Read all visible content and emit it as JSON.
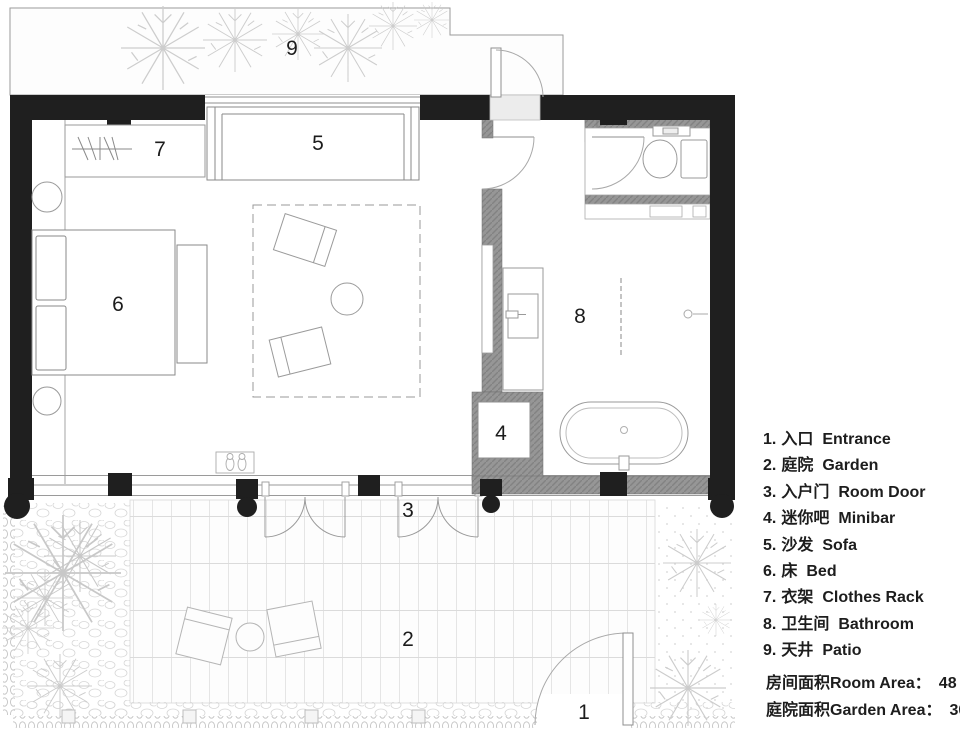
{
  "plan": {
    "labels": {
      "r1": "1",
      "r2": "2",
      "r3": "3",
      "r4": "4",
      "r5": "5",
      "r6": "6",
      "r7": "7",
      "r8": "8",
      "r9": "9"
    }
  },
  "legend": {
    "items": [
      {
        "num": "1.",
        "zh": "入口",
        "en": "Entrance"
      },
      {
        "num": "2.",
        "zh": "庭院",
        "en": "Garden"
      },
      {
        "num": "3.",
        "zh": "入户门",
        "en": "Room Door"
      },
      {
        "num": "4.",
        "zh": "迷你吧",
        "en": "Minibar"
      },
      {
        "num": "5.",
        "zh": "沙发",
        "en": "Sofa"
      },
      {
        "num": "6.",
        "zh": "床",
        "en": "Bed"
      },
      {
        "num": "7.",
        "zh": "衣架",
        "en": "Clothes Rack"
      },
      {
        "num": "8.",
        "zh": "卫生间",
        "en": "Bathroom"
      },
      {
        "num": "9.",
        "zh": "天井",
        "en": "Patio"
      }
    ]
  },
  "areas": {
    "rows": [
      {
        "zh": "房间面积",
        "en": "Room Area",
        "sep": "：",
        "value": "48",
        "unit": "㎡"
      },
      {
        "zh": "庭院面积",
        "en": "Garden Area",
        "sep": "：",
        "value": "30",
        "unit": "㎡"
      }
    ]
  },
  "colors": {
    "wall": "#1f1f1f",
    "partition_wall": "#969696",
    "line": "#8a8a8a",
    "background": "#ffffff"
  }
}
